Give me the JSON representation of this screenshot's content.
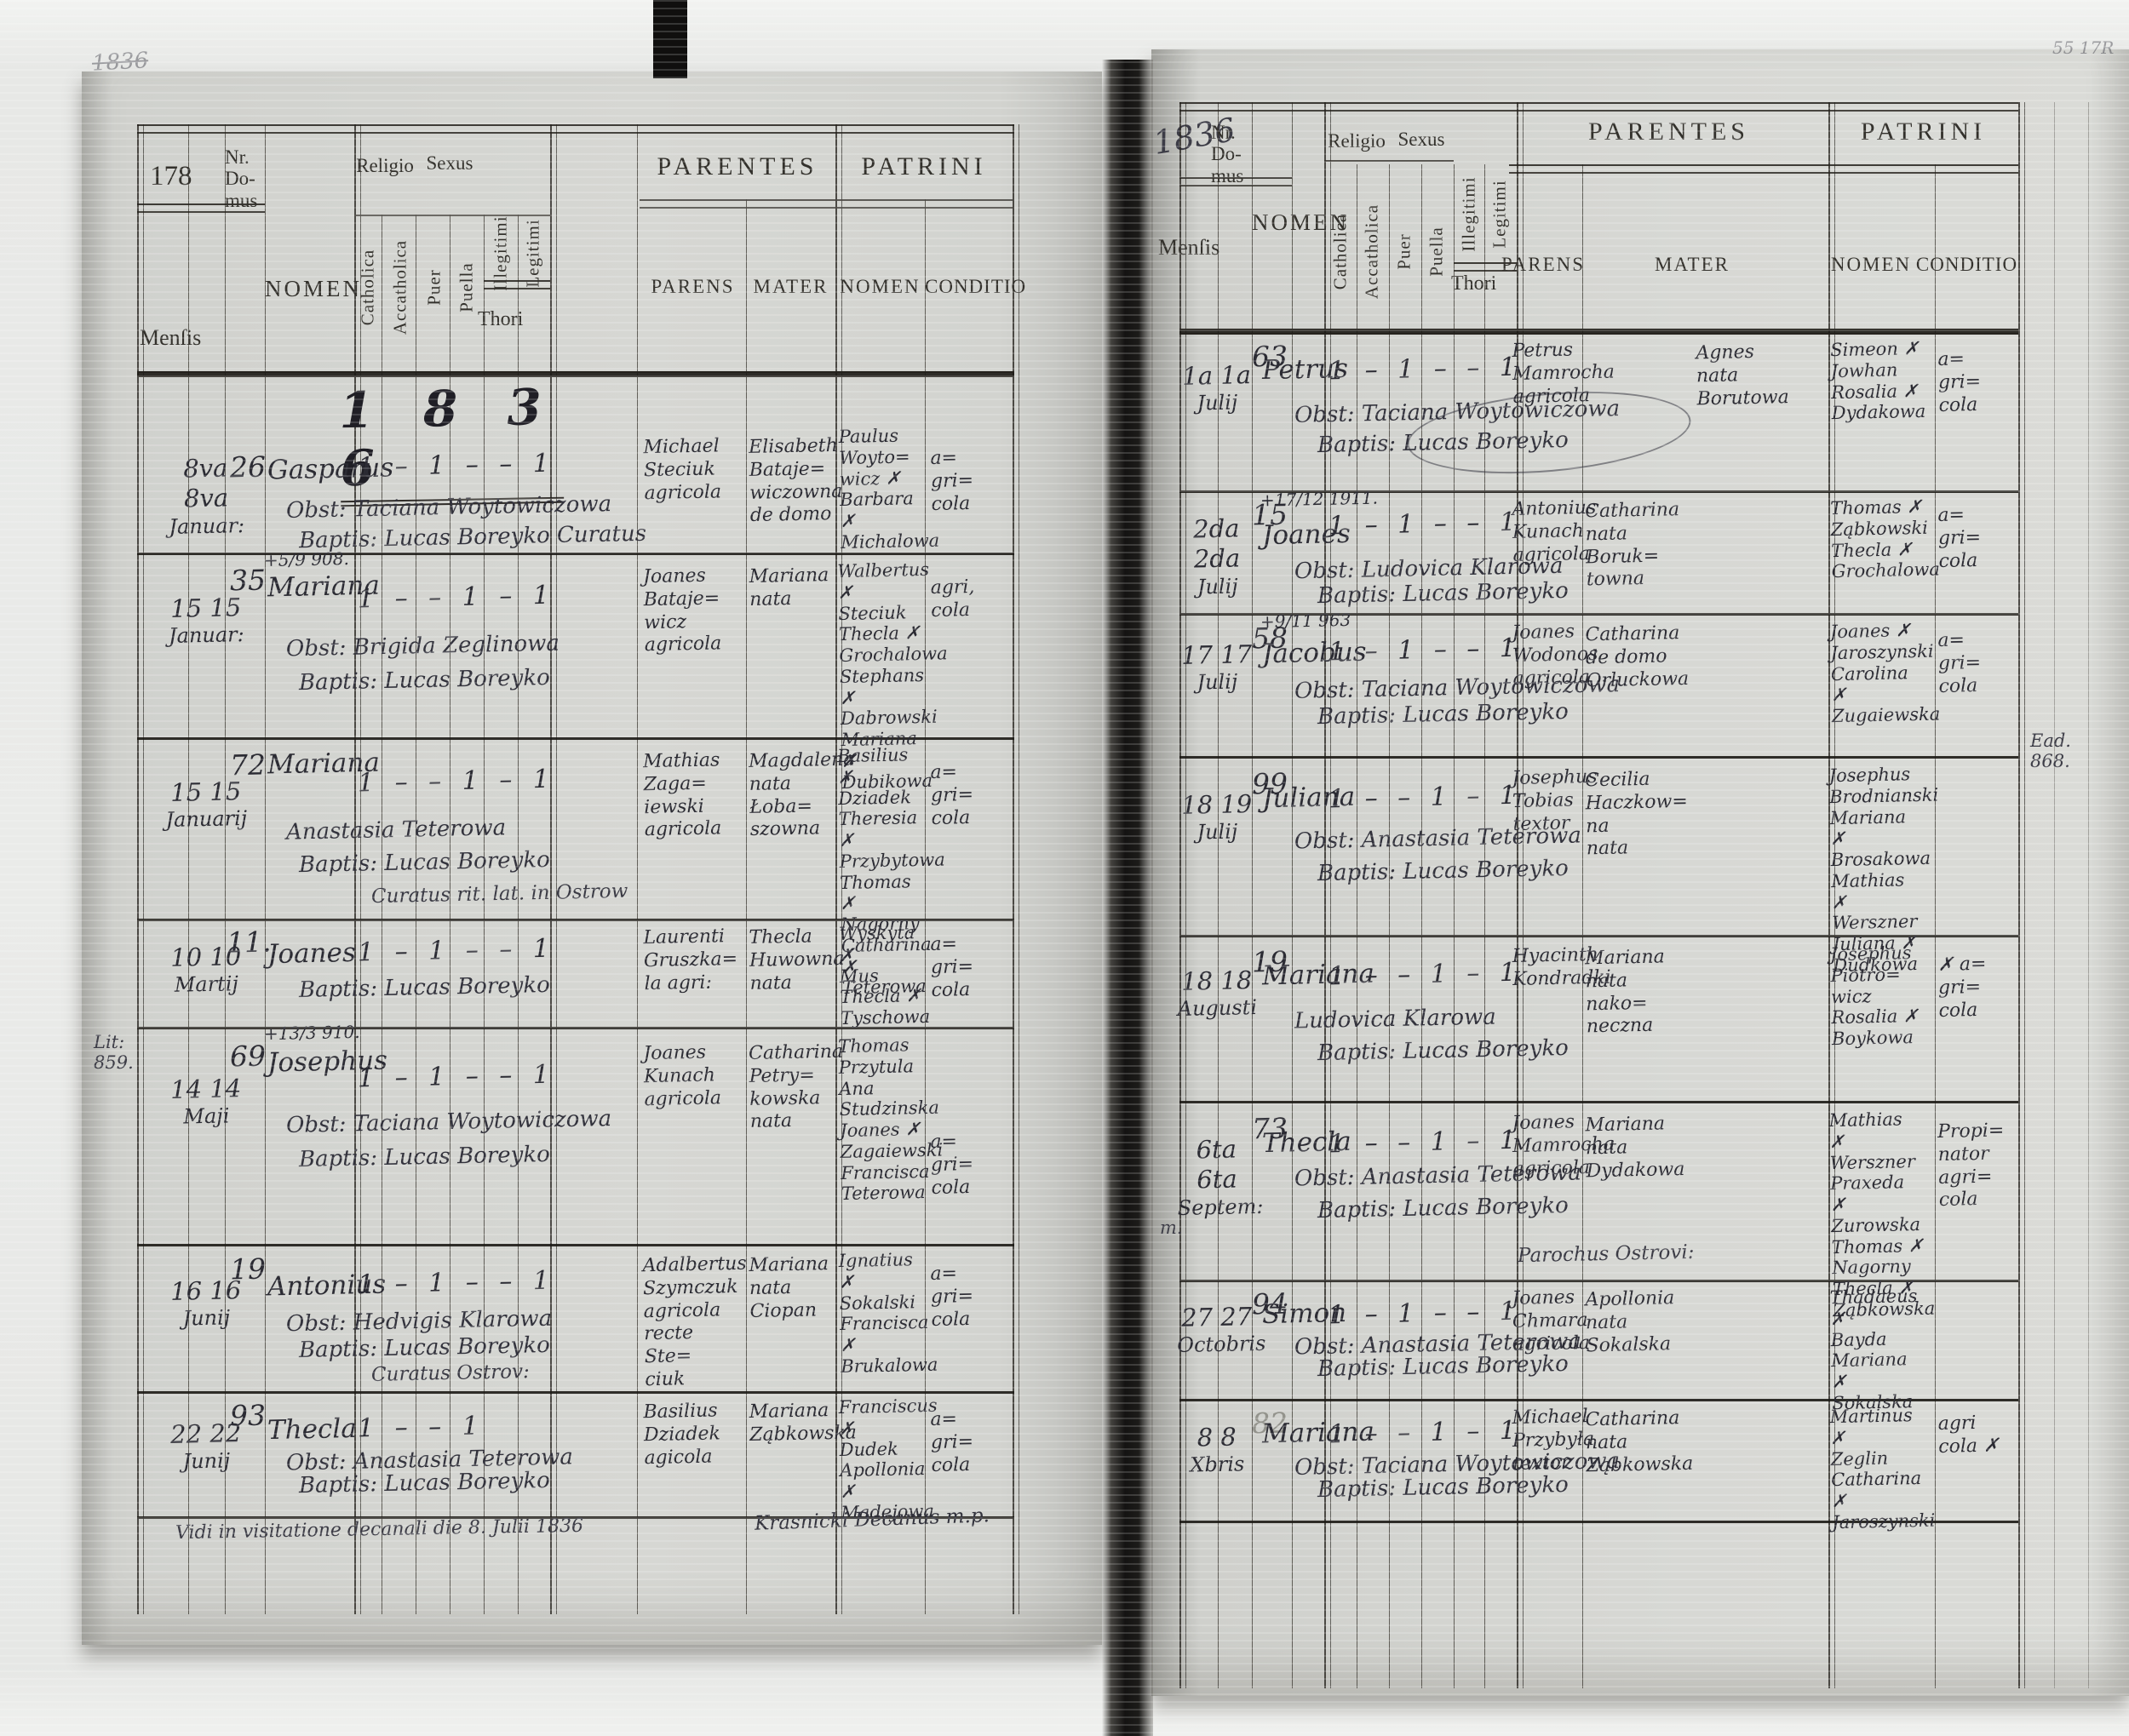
{
  "headers": {
    "nr_domus": "Nr.\nDo-\nmus",
    "mensis": "Menſis",
    "nomen": "NOMEN",
    "religio": "Religio",
    "sexus": "Sexus",
    "catholica": "Catholica",
    "accatholica": "Accatholica",
    "puer": "Puer",
    "puella": "Puella",
    "illegitimi": "Illegitimi",
    "legitimi": "Legitimi",
    "thori": "Thori",
    "parentes": "PARENTES",
    "parens": "PARENS",
    "mater": "MATER",
    "patrini": "PATRINI",
    "patrini_nomen": "NOMEN",
    "conditio": "CONDITIO"
  },
  "left_page": {
    "page_number": "178",
    "top_scribble": "1836",
    "year_heading": "1 8 3 6",
    "margin_note": "Lit:\n859.",
    "footer_note": "Vidi in visitatione decanali die 8. Julii 1836",
    "footer_signature": "Krasnicki Decanus m.p.",
    "rows": [
      {
        "day": "8va 8va",
        "month": "Januar:",
        "house": "26",
        "name": "Gasparus",
        "obst": "Obst: Taciana Woytowiczowa",
        "bapt": "Baptis: Lucas Boreyko Curatus",
        "ticks": "1 – 1 – – 1",
        "parens": "Michael\nSteciuk\nagricola",
        "mater": "Elisabeth\nBataje=\nwiczowna\nde domo",
        "patrini": "Paulus\nWoyto=\nwicz ✗\nBarbara ✗\nMichalowa",
        "conditio": "a=\ngri=\ncola"
      },
      {
        "day": "15 15",
        "month": "Januar:",
        "house": "35",
        "note": "+5/9 908.",
        "name": "Mariana",
        "obst": "Obst: Brigida Zeglinowa",
        "bapt": "Baptis: Lucas Boreyko",
        "ticks": "1 – – 1 – 1",
        "parens": "Joanes\nBataje=\nwicz\nagricola",
        "mater": "Mariana\nnata",
        "patrini": "Walbertus ✗\nSteciuk\nThecla ✗\nGrochalowa\nStephans ✗\nDabrowski\nMariana ✗\nDubikowa",
        "conditio": "agri,\ncola"
      },
      {
        "day": "15 15",
        "month": "Januarij",
        "house": "72",
        "name": "Mariana",
        "obst": "Anastasia Teterowa",
        "bapt": "Baptis: Lucas Boreyko",
        "bapt2": "Curatus rit. lat. in Ostrow",
        "ticks": "1 – – 1 – 1",
        "parens": "Mathias\nZaga=\niewski\nagricola",
        "mater": "Magdalena\nnata\nŁoba=\nszowna",
        "patrini": "Basilius ✗\nDziadek\nTheresia ✗\nPrzybytowa\nThomas ✗\nNagorny\nCatharina ✗\nTeterowa",
        "conditio": "a=\ngri=\ncola"
      },
      {
        "day": "10 10",
        "month": "Martij",
        "house": "11.",
        "name": "Joanes",
        "bapt": "Baptis: Lucas Boreyko",
        "ticks": "1 – 1 – – 1",
        "parens": "Laurenti\nGruszka=\nla agri:",
        "mater": "Thecla\nHuwowna\nnata",
        "patrini": "Wyskyta ✗\nMus\nThecla ✗\nTyschowa",
        "conditio": "a=\ngri=\ncola"
      },
      {
        "day": "14 14",
        "month": "Maji",
        "house": "69",
        "note": "+13/3 910.",
        "name": "Josephus",
        "obst": "Obst: Taciana Woytowiczowa",
        "bapt": "Baptis: Lucas Boreyko",
        "ticks": "1 – 1 – – 1",
        "parens": "Joanes\nKunach\nagricola",
        "mater": "Catharina\nPetry=\nkowska\nnata",
        "patrini": "Thomas\nPrzytula\nAna\nStudzinska\nJoanes ✗\nZagaiewski\nFrancisca\nTeterowa",
        "conditio": "a=\ngri=\ncola"
      },
      {
        "day": "16 16",
        "month": "Junij",
        "house": "19",
        "name": "Antonius",
        "obst": "Obst: Hedvigis Klarowa",
        "bapt": "Baptis: Lucas Boreyko",
        "bapt2": "Curatus Ostrov:",
        "ticks": "1 – 1 – – 1",
        "parens": "Adalbertus\nSzymczuk\nagricola\nrecte Ste=\nciuk",
        "mater": "Mariana\nnata\nCiopan",
        "patrini": "Ignatius ✗\nSokalski\nFrancisca ✗\nBrukalowa",
        "conditio": "a=\ngri=\ncola"
      },
      {
        "day": "22 22",
        "month": "Junij",
        "house": "93",
        "name": "Thecla",
        "obst": "Obst: Anastasia Teterowa",
        "bapt": "Baptis: Lucas Boreyko",
        "ticks": "1 – – 1",
        "parens": "Basilius\nDziadek\nagicola",
        "mater": "Mariana\nZąbkowska",
        "patrini": "Franciscus ✗\nDudek\nApollonia ✗\nMadejowa",
        "conditio": "a=\ngri=\ncola"
      }
    ]
  },
  "right_page": {
    "year_note": "1836",
    "corner_note": "55 17R",
    "margin_note_eod": "Ead.\n868.",
    "margin_note_m": "m.",
    "rows": [
      {
        "day": "1a 1a",
        "month": "Julij",
        "house": "63",
        "name": "Petrus",
        "obst": "Obst: Taciana Woytowiczowa",
        "bapt": "Baptis: Lucas Boreyko",
        "ticks": "1 – 1 – – 1",
        "parens": "Petrus\nMamrocha\nagricola",
        "mater": "Agnes\nnata\nBorutowa",
        "patrini": "Simeon ✗\nJowhan\nRosalia ✗\nDydakowa",
        "conditio": "a=\ngri=\ncola"
      },
      {
        "day": "2da 2da",
        "month": "Julij",
        "house": "15",
        "note": "+17/12 1911.",
        "name": "Joanes",
        "obst": "Obst: Ludovica Klarowa",
        "bapt": "Baptis: Lucas Boreyko",
        "ticks": "1 – 1 – – 1",
        "parens": "Antonius\nKunach\nagricola",
        "mater": "Catharina\nnata\nBoruk=\ntowna",
        "patrini": "Thomas ✗\nZąbkowski\nThecla ✗\nGrochalowa",
        "conditio": "a=\ngri=\ncola"
      },
      {
        "day": "17 17",
        "month": "Julij",
        "house": "58",
        "note": "+9/11 963",
        "name": "Jacobus",
        "obst": "Obst: Taciana Woytowiczowa",
        "bapt": "Baptis: Lucas Boreyko",
        "ticks": "1 – 1 – – 1",
        "parens": "Joanes\nWodonos\nagricola",
        "mater": "Catharina\nde domo\nOrluckowa",
        "patrini": "Joanes ✗\nJaroszynski\nCarolina ✗\nZugaiewska",
        "conditio": "a=\ngri=\ncola"
      },
      {
        "day": "18 19",
        "month": "Julij",
        "house": "99",
        "name": "Juliana",
        "obst": "Obst: Anastasia Teterowa",
        "bapt": "Baptis: Lucas Boreyko",
        "ticks": "1 – – 1 – 1",
        "parens": "Josephus\nTobias\ntextor",
        "mater": "Cecilia\nHaczkow=\nna\nnata",
        "patrini": "Josephus\nBrodnianski\nMariana ✗\nBrosakowa\nMathias ✗\nWerszner\nJuliana ✗\nDudkowa"
      },
      {
        "day": "18 18",
        "month": "Augusti",
        "house": "19",
        "name": "Mariana",
        "obst": "Ludovica Klarowa",
        "bapt": "Baptis: Lucas Boreyko",
        "ticks": "1 – – 1 – 1",
        "parens": "Hyacinth\nKondradki",
        "mater": "Mariana\nnata\nnako=\nneczna",
        "patrini": "Josephus\nPiotro=\nwicz\nRosalia ✗\nBoykowa",
        "conditio": "✗ a=\ngri=\ncola"
      },
      {
        "day": "6ta 6ta",
        "month": "Septem:",
        "house": "73",
        "name": "Thecla",
        "obst": "Obst: Anastasia Teterowa",
        "bapt": "Baptis: Lucas Boreyko",
        "bapt2": "Parochus Ostrovi:",
        "ticks": "1 – – 1 – 1",
        "parens": "Joanes\nMamrocha\nagricola",
        "mater": "Mariana\nnata\nDydakowa",
        "patrini": "Mathias ✗\nWerszner\nPraxeda ✗\nZurowska\nThomas ✗\nNagorny\nThecla ✗\nZąbkowska",
        "conditio": "Propi=\nnator\nagri=\ncola"
      },
      {
        "day": "27 27",
        "month": "Octobris",
        "house": "94",
        "name": "Simon",
        "obst": "Obst: Anastasia Teterowa",
        "bapt": "Baptis: Lucas Boreyko",
        "ticks": "1 – 1 – – 1",
        "parens": "Joanes\nChmara\nagricola",
        "mater": "Apollonia\nnata\nSokalska",
        "patrini": "Thadaeus ✗\nBayda\nMariana ✗\nSokalska"
      },
      {
        "day": "8 8",
        "month": "Xbris",
        "house": "82",
        "name": "Mariana",
        "obst": "Obst: Taciana Woytowiczowa",
        "bapt": "Baptis: Lucas Boreyko",
        "ticks": "1 – – 1 – 1",
        "parens": "Michael\nPrzybyła\ntextor",
        "mater": "Catharina\nnata\nZąbkowska",
        "patrini": "Martinus ✗\nZeglin\nCatharina ✗\nJaroszynski",
        "conditio": "agri\ncola ✗"
      }
    ]
  }
}
